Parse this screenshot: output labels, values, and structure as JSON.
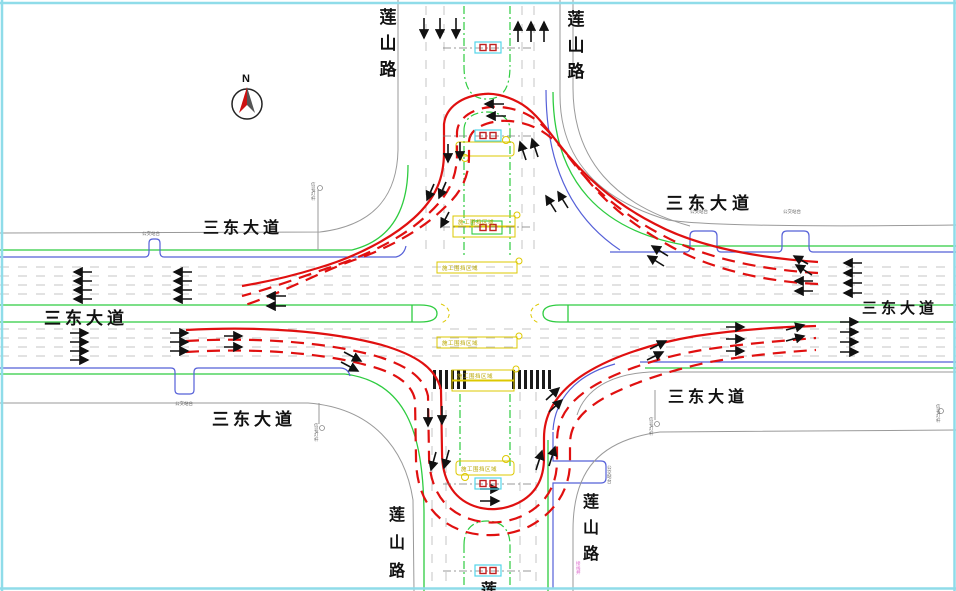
{
  "drawing": {
    "type": "intersection-traffic-organization-plan",
    "bg_color": "#ffffff",
    "frame_color": "#8fdce9"
  },
  "compass": {
    "label": "N"
  },
  "road_names": {
    "ew": "三东大道",
    "ns": "莲山路",
    "ns_partial": "莲"
  },
  "annotations": {
    "bus_bay": "公交站台",
    "construction": "施工围挡区域",
    "pole": "信号灯杆",
    "pipe": "接线井"
  },
  "colors": {
    "detour_red": "#e01010",
    "curb_gray": "#9a9a9a",
    "edge_green": "#2ecc40",
    "edge_blue": "#5560d8",
    "construction_yellow": "#ddc800",
    "signal_cyan": "#55d4e8",
    "arrow_black": "#111111"
  }
}
